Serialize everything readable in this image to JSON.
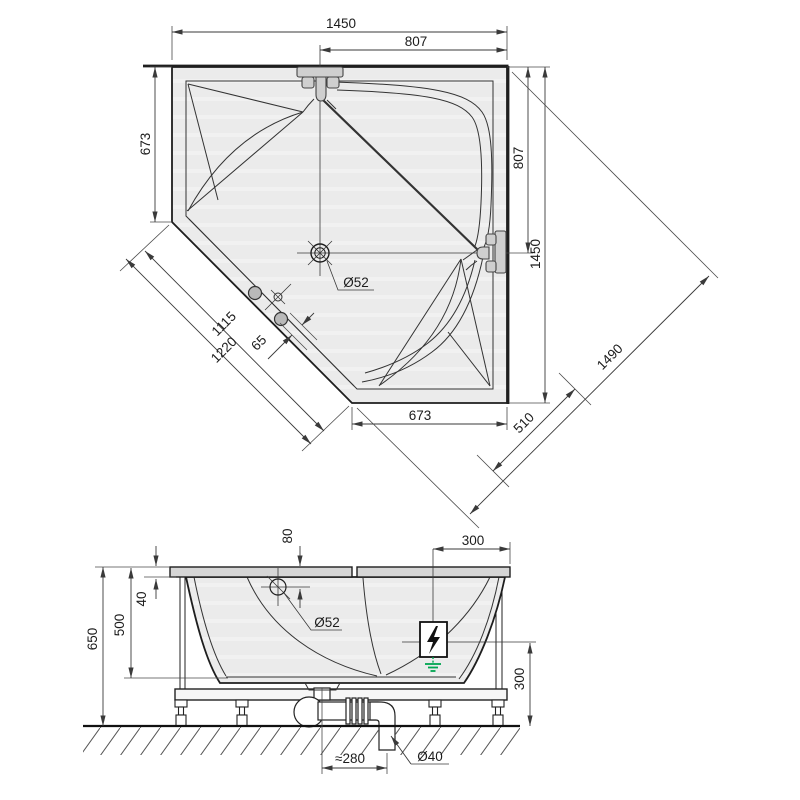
{
  "title": "corner-bathtub-installation-drawing",
  "colors": {
    "line": "#1e1e1e",
    "dimension_line": "#3a3a3a",
    "tub_fill": "#ebebeb",
    "fitting_fill": "#cfcfcf",
    "ground_symbol_green": "#00a651"
  },
  "top_view": {
    "dims": {
      "overall_width": "1450",
      "faucet_offset_top": "807",
      "left_side": "673",
      "faucet_offset_right": "807",
      "overall_height": "1450",
      "diagonal_overall": "1490",
      "corner_panel": "510",
      "bottom_side": "673",
      "front_edge_inner": "1115",
      "front_edge_outer": "1220",
      "handle_offset": "65",
      "drain_diameter": "Ø52"
    }
  },
  "side_view": {
    "dims": {
      "drain_below_rim": "80",
      "deck_width_right": "300",
      "rim_thickness": "40",
      "inner_depth": "500",
      "total_height": "650",
      "drain_diameter": "Ø52",
      "connection_height": "300",
      "trap_offset": "≈280",
      "waste_pipe_diameter": "Ø40"
    }
  }
}
